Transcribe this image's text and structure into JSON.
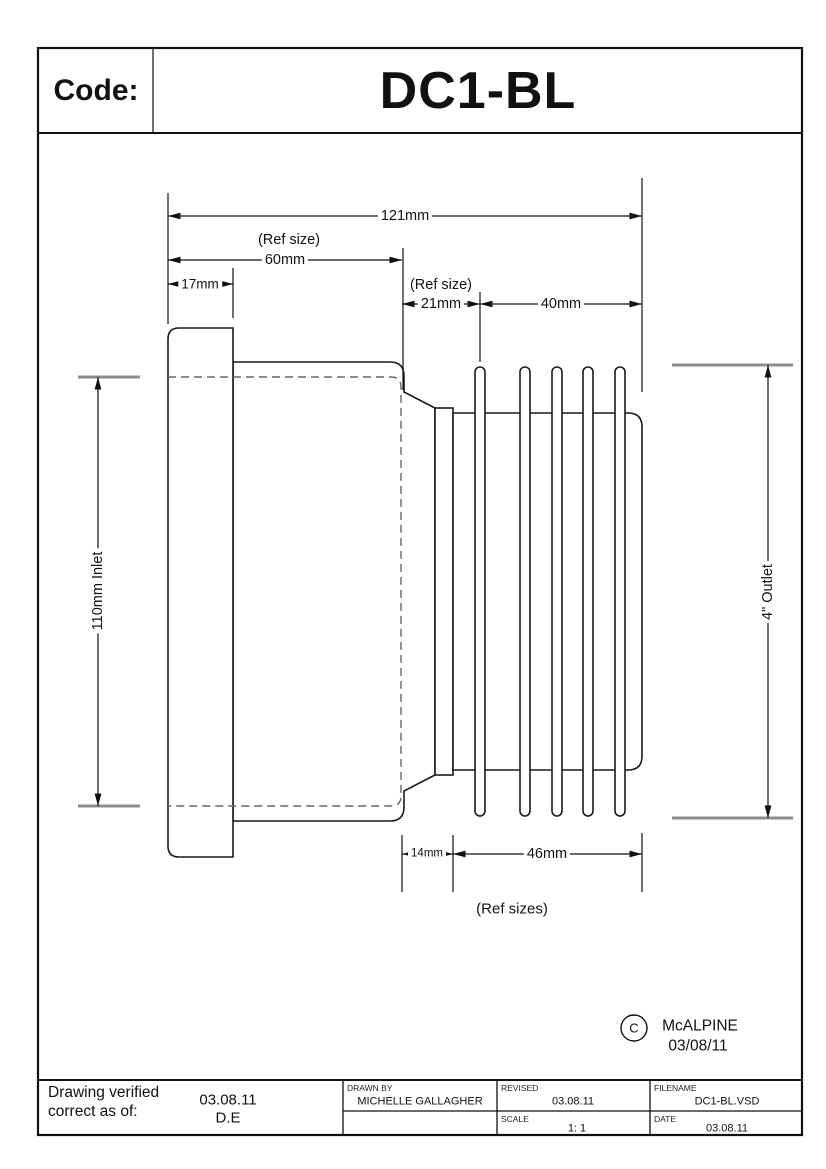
{
  "title_block": {
    "code_label": "Code:",
    "code_value": "DC1-BL"
  },
  "dimensions": {
    "overall_length": "121mm",
    "ref_size_top": "(Ref size)",
    "body_length": "60mm",
    "flange_length": "17mm",
    "ref_size_mid": "(Ref size)",
    "neck_length_top": "21mm",
    "fin_section_top": "40mm",
    "inlet_diameter": "110mm Inlet",
    "outlet_diameter": "4\" Outlet",
    "neck_length_bottom": "14mm",
    "fin_section_bottom": "46mm",
    "ref_sizes_note": "(Ref sizes)"
  },
  "copyright": {
    "symbol": "C",
    "company": "McALPINE",
    "date": "03/08/11"
  },
  "info_table": {
    "verified_label": "Drawing verified correct as of:",
    "verified_date": "03.08.11",
    "verified_initials": "D.E",
    "drawn_by_label": "DRAWN BY",
    "drawn_by_value": "MICHELLE GALLAGHER",
    "revised_label": "REVISED",
    "revised_value": "03.08.11",
    "scale_label": "SCALE",
    "scale_value": "1: 1",
    "filename_label": "FILENAME",
    "filename_value": "DC1-BL.VSD",
    "date_label": "DATE",
    "date_value": "03.08.11"
  },
  "colors": {
    "line": "#1a1a1a",
    "dim_line": "#111111",
    "hidden_line": "#666666",
    "dim_tick": "#8c8c8c",
    "background": "#ffffff"
  }
}
